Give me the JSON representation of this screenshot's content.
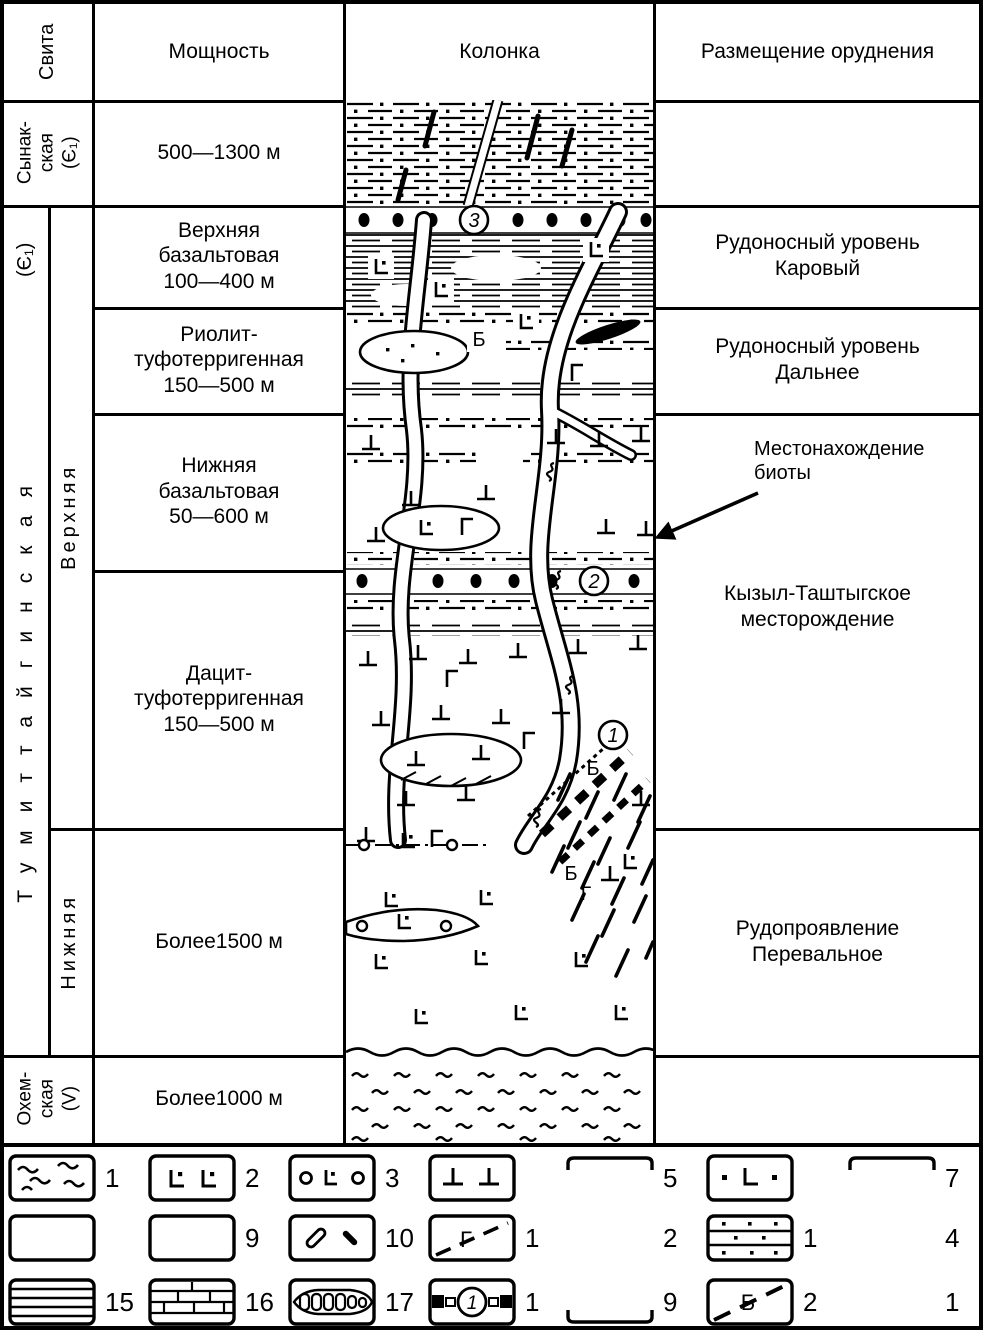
{
  "header": {
    "suite": "Свита",
    "thickness": "Мощность",
    "column": "Колонка",
    "ore_placement": "Размещение оруднения"
  },
  "suite_col": {
    "synak": "Сынак-\nская\n(Є₁)",
    "tumit_index": "(Є₁)",
    "tumit": "Тумиттайгинская",
    "upper": "Верхняя",
    "lower": "Нижняя",
    "okhem": "Охем-\nская\n(V)"
  },
  "thickness": {
    "rows": [
      {
        "text": "500—1300 м"
      },
      {
        "text": "Верхняя\nбазальтовая\n100—400 м"
      },
      {
        "text": "Риолит-\nтуфотерригенная\n150—500 м"
      },
      {
        "text": "Нижняя\nбазальтовая\n50—600 м"
      },
      {
        "text": "Дацит-\nтуфотерригенная\n150—500 м"
      },
      {
        "text": "Более1500 м"
      },
      {
        "text": "Более1000 м"
      }
    ]
  },
  "ore": {
    "karovy": "Рудоносный уровень\nКаровый",
    "dalnee": "Рудоносный уровень\nДальнее",
    "biota_note": "Местонахождение\nбиоты",
    "kyzyl": "Кызыл-Таштыгское\nместорождение",
    "perevalnoe": "Рудопроявление\nПеревальное"
  },
  "column_markers": {
    "level3": "3",
    "level2": "2",
    "level1": "1",
    "letter_b_upper": "Б",
    "letter_b_middle": "Б",
    "letter_b_lower": "Б",
    "letter_g_lower": "Г"
  },
  "legend": {
    "letters": {
      "gamma": "Г",
      "b": "Б",
      "ore_index": "1"
    },
    "rows": [
      [
        {
          "symbol": "wavy-schist",
          "num": "1"
        },
        {
          "symbol": "basalt-L",
          "num": "2"
        },
        {
          "symbol": "amygdaloidal-basalt",
          "num": "3"
        },
        {
          "symbol": "diabase-perp",
          "num": ""
        },
        {
          "symbol": "open-top-box",
          "num": "5"
        },
        {
          "symbol": "dotted-basalt",
          "num": ""
        },
        {
          "symbol": "open-top-box",
          "num": "7"
        }
      ],
      [
        {
          "symbol": "empty-box",
          "num": ""
        },
        {
          "symbol": "empty-box",
          "num": "9"
        },
        {
          "symbol": "dike-rods",
          "num": "10"
        },
        {
          "symbol": "gamma-dash",
          "num": "1"
        },
        {
          "symbol": "none",
          "num": "2"
        },
        {
          "symbol": "tuff-sandstone",
          "num": "1"
        },
        {
          "symbol": "none",
          "num": "4"
        }
      ],
      [
        {
          "symbol": "siltstone-lines",
          "num": "15"
        },
        {
          "symbol": "limestone-bricks",
          "num": "16"
        },
        {
          "symbol": "conglomerate-chain",
          "num": "17"
        },
        {
          "symbol": "ore-level-circled",
          "num": "1"
        },
        {
          "symbol": "open-bottom-box",
          "num": "9"
        },
        {
          "symbol": "b-dash",
          "num": "2"
        },
        {
          "symbol": "none",
          "num": "1"
        }
      ]
    ]
  }
}
